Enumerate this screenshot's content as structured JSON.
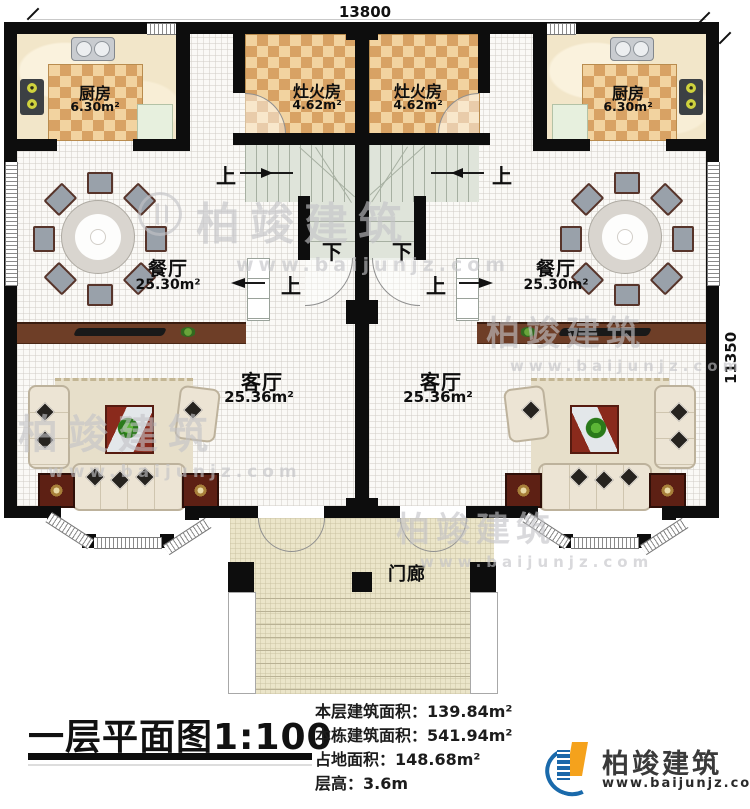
{
  "dimensions": {
    "top": "13800",
    "right": "11350"
  },
  "rooms": {
    "kitchen": {
      "name": "厨房",
      "area": "6.30m²"
    },
    "stove_room": {
      "name": "灶火房",
      "area": "4.62m²"
    },
    "dining": {
      "name": "餐厅",
      "area": "25.30m²"
    },
    "living": {
      "name": "客厅",
      "area": "25.36m²"
    },
    "porch": {
      "name": "门廊"
    }
  },
  "stairs": {
    "up": "上",
    "down": "下"
  },
  "footer": {
    "title": "一层平面图1:100",
    "stats": [
      "本层建筑面积：139.84m²",
      "本栋建筑面积：541.94m²",
      "占地面积：148.68m²",
      "层高：3.6m"
    ],
    "brand": {
      "name": "柏竣建筑",
      "site": "www.baijunjz.com"
    }
  },
  "watermark": {
    "name": "柏竣建筑",
    "site": "www.baijunjz.com"
  },
  "colors": {
    "wall": "#0d0d0d",
    "checker_dark": "#d8a264",
    "checker_light": "#f2d3a0",
    "stair": "#dfe4da",
    "porch_floor": "#ebe5c9",
    "cabinet_wood": "#6e3e27",
    "accent_wood": "#5d2014",
    "brand_blue": "#1a6aab",
    "brand_orange": "#f5a21c"
  }
}
